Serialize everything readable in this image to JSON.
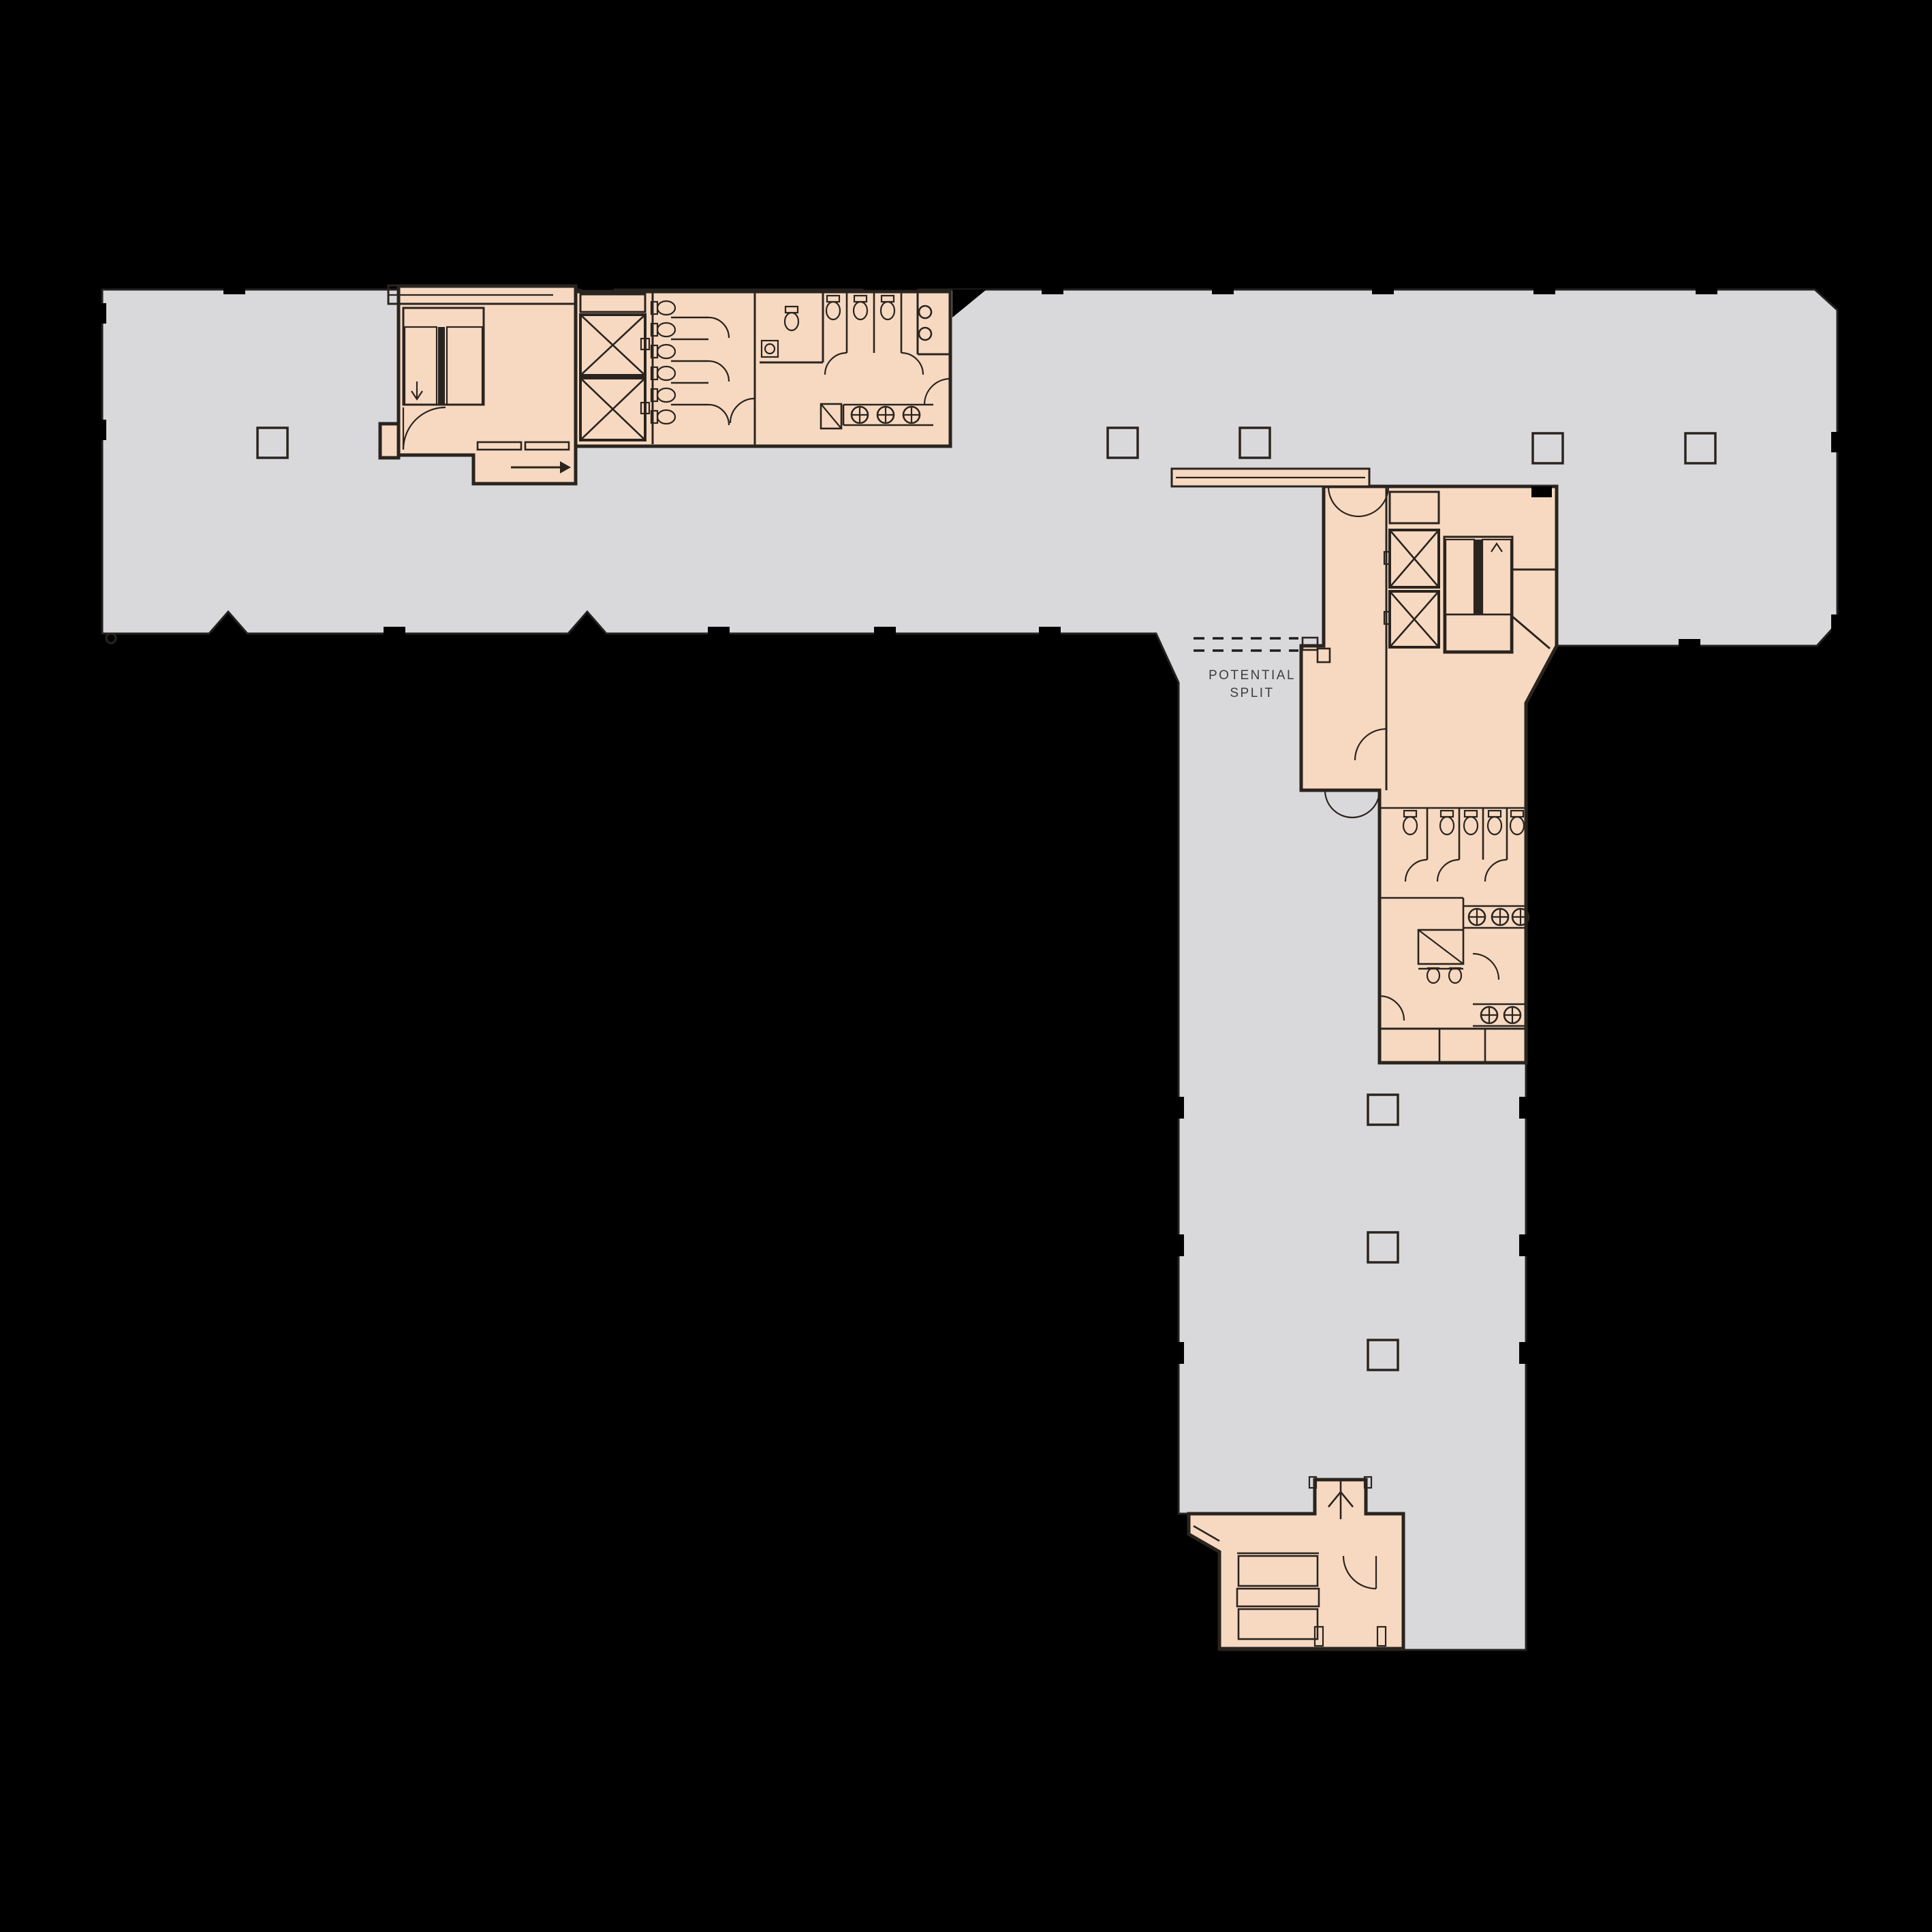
{
  "annotation": {
    "line1": "POTENTIAL",
    "line2": "SPLIT"
  },
  "colors": {
    "background": "#000000",
    "floor": "#d9d9db",
    "core": "#f7d9c1",
    "wall": "#2a241f",
    "label": "#3d3d40"
  }
}
